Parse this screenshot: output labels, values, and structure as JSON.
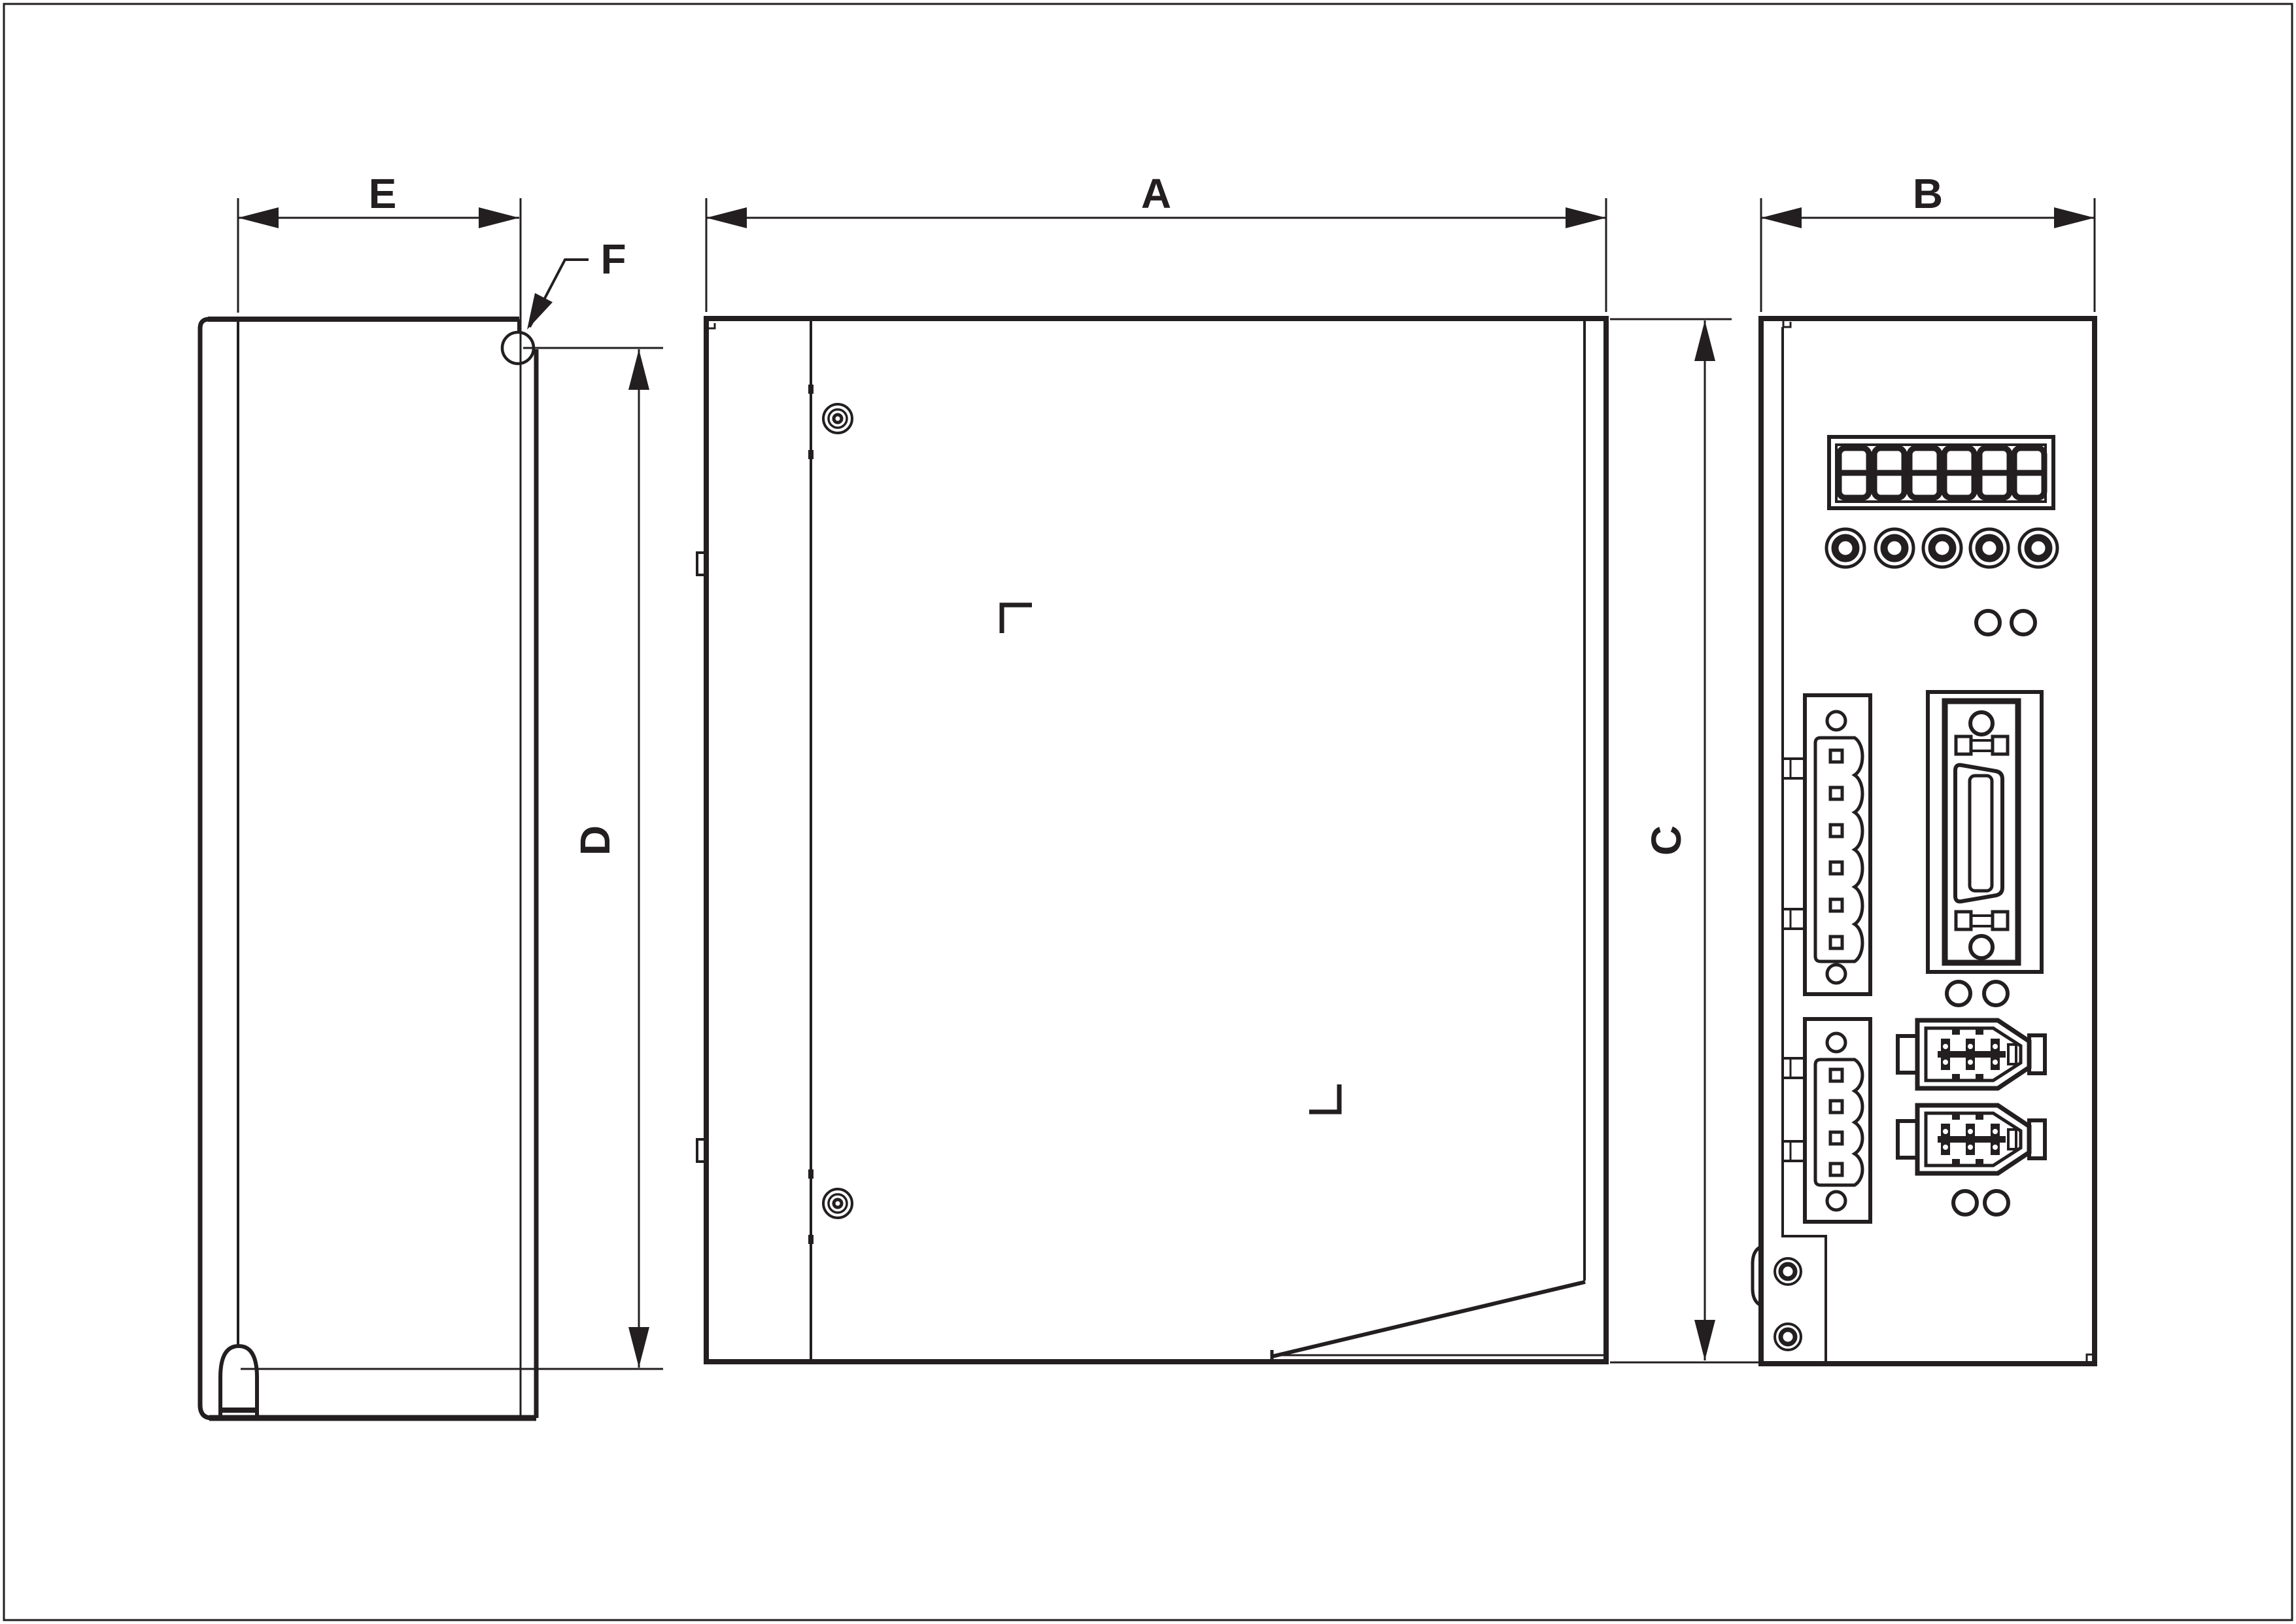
{
  "drawing": {
    "kind": "technical outline drawing, three orthographic views of a servo drive unit",
    "background": "#ffffff",
    "line_color": "#231f20",
    "border": "thin rectangular frame around sheet"
  },
  "views": {
    "left": {
      "name": "left side view",
      "features": [
        "mounting hook top-right (detail F)",
        "mounting foot arch bottom-left"
      ]
    },
    "center": {
      "name": "front/side face view",
      "features": [
        "two captive screws",
        "panel corner marks",
        "bottom-right wedge foot"
      ]
    },
    "right": {
      "name": "connector panel view",
      "features": [
        "seven-segment display",
        "five push buttons",
        "status LEDs",
        "power connector",
        "auxiliary connector",
        "I/O connector",
        "two encoder ports",
        "two fixing screws"
      ]
    }
  },
  "dimension_labels": {
    "A": "A",
    "B": "B",
    "C": "C",
    "D": "D",
    "E": "E",
    "F": "F"
  },
  "panel": {
    "display": {
      "style": "seven-segment",
      "digit_count": 6,
      "value": "888888"
    },
    "buttons": {
      "count": 5,
      "shape": "round"
    },
    "led_pairs": {
      "count": 3,
      "per_pair": 2
    },
    "connectors": [
      "6-pin power plug with two side tabs",
      "4-pin plug with two side tabs",
      "SCSI-type I/O connector with latch clips",
      "encoder port 1",
      "encoder port 2"
    ],
    "screws": {
      "count": 2
    }
  }
}
